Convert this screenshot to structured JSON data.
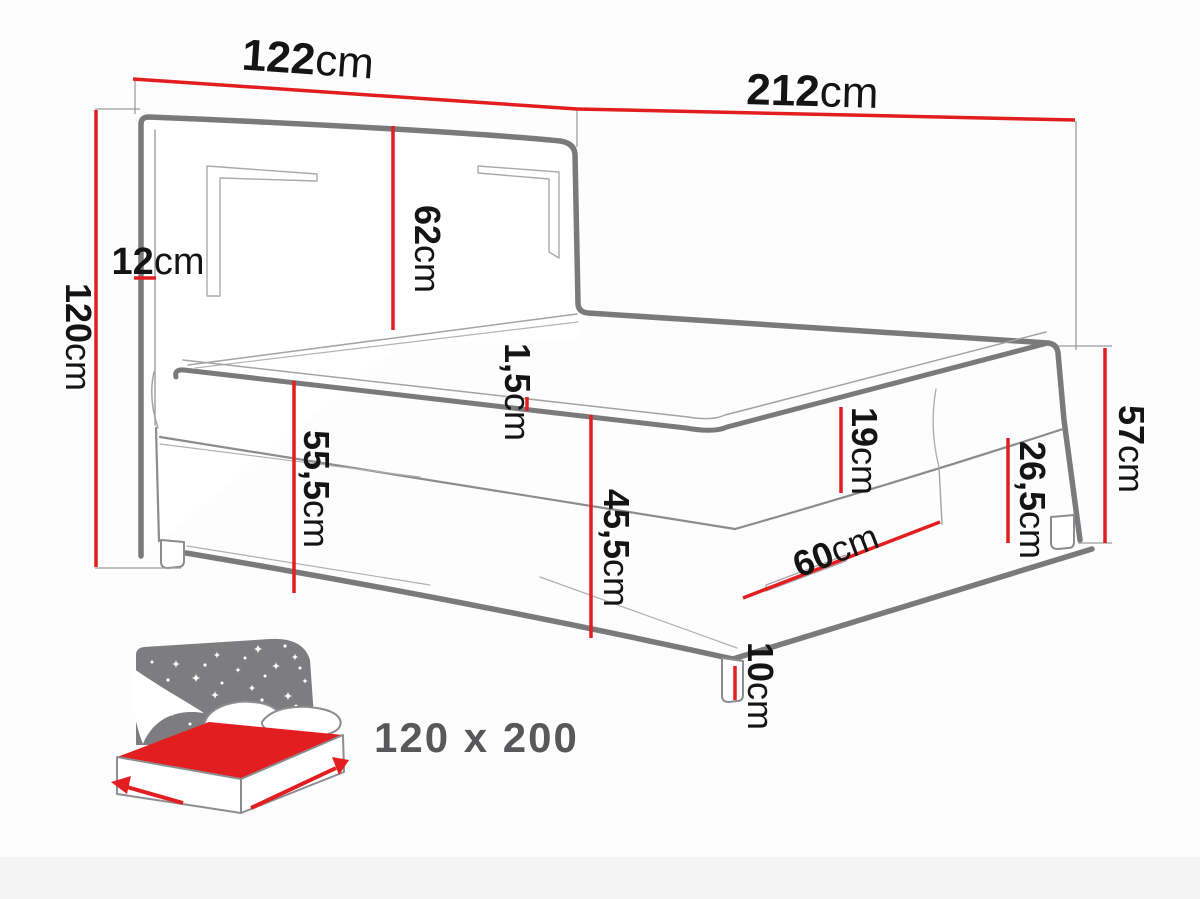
{
  "diagram": {
    "type": "bed-dimension-diagram",
    "dims": {
      "w122": {
        "v": "122",
        "u": "cm"
      },
      "l212": {
        "v": "212",
        "u": "cm"
      },
      "h120": {
        "v": "120",
        "u": "cm"
      },
      "t12": {
        "v": "12",
        "u": "cm"
      },
      "h62": {
        "v": "62",
        "u": "cm"
      },
      "t15": {
        "v": "1,5",
        "u": "cm"
      },
      "h555": {
        "v": "55,5",
        "u": "cm"
      },
      "h455": {
        "v": "45,5",
        "u": "cm"
      },
      "h19": {
        "v": "19",
        "u": "cm"
      },
      "h265": {
        "v": "26,5",
        "u": "cm"
      },
      "h57": {
        "v": "57",
        "u": "cm"
      },
      "d60": {
        "v": "60",
        "u": "cm"
      },
      "h10": {
        "v": "10",
        "u": "cm"
      }
    },
    "icon": {
      "size_label": "120 x 200"
    },
    "colors": {
      "dimension_red": "#e31e21",
      "outline_gray": "#7a7a7c",
      "thin_gray": "#a4a4a6",
      "label_black": "#141414",
      "icon_panel_gray": "#7d7d80",
      "size_text_gray": "#58585a"
    }
  }
}
